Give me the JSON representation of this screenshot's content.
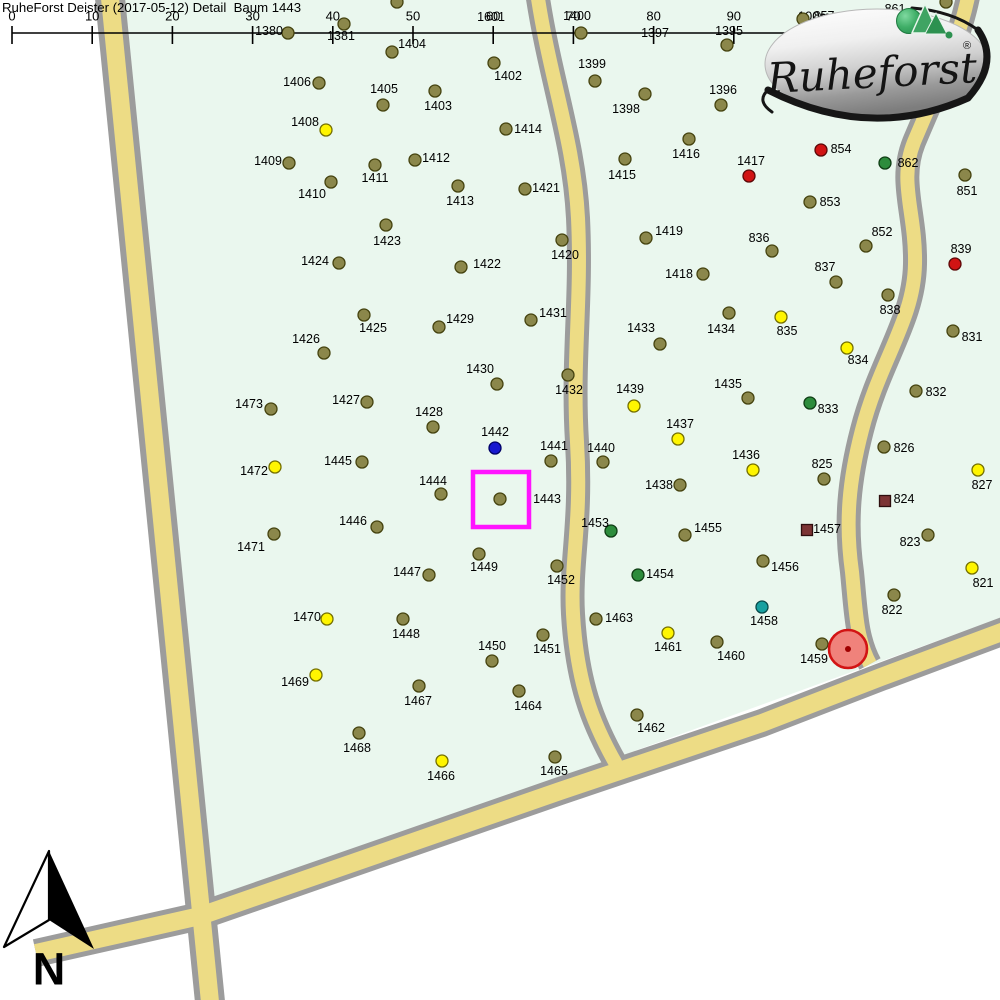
{
  "header": {
    "title": "RuheForst Deister (2017-05-12) Detail  Baum 1443"
  },
  "scale_bar": {
    "labels": [
      "0",
      "10",
      "20",
      "30",
      "40",
      "50",
      "60",
      "70",
      "80",
      "90",
      "100m"
    ],
    "x_start": 12,
    "x_step": 80.2,
    "line_y": 33,
    "tick_top": 26,
    "tick_bottom": 44,
    "label_y": 16
  },
  "logo": {
    "name": "Ruheforst",
    "registered": "®"
  },
  "north_arrow": {
    "label": "N"
  },
  "selection": {
    "selected_tree": "1443",
    "rect": {
      "x": 473,
      "y": 472,
      "w": 56,
      "h": 55,
      "color": "#FF14FF"
    },
    "marker_circle": {
      "x": 848,
      "y": 649,
      "r": 19,
      "fill": "#F0827B",
      "stroke": "#D21414",
      "core": "#A00000"
    }
  },
  "map": {
    "outside": "#FFFFFF",
    "bg": "#EAF7EE",
    "area_polygon": "124,0 1000,0 1000,618 203,908",
    "road_colors": {
      "casing": "#9C9C9C",
      "fill": "#EDDC85"
    },
    "roads": [
      {
        "name": "road-left",
        "path": "M109,-12 L211,1012",
        "outer": 30,
        "inner": 18
      },
      {
        "name": "road-bottom",
        "path": "M36,953 L200,916 L560,791 L762,723 L881,677 L1015,627",
        "outer": 28,
        "inner": 18
      },
      {
        "name": "road-middle",
        "path": "M537,-8 C550,80 574,140 578,218 C582,300 572,360 577,442 C582,524 570,562 573,614 C577,682 592,722 616,764",
        "outer": 24,
        "inner": 14
      },
      {
        "name": "road-right",
        "path": "M969,-8 C960,40 938,85 914,142 C898,182 916,212 915,264 C914,320 880,360 862,430 C849,480 845,522 852,572 C856,612 856,638 870,664",
        "outer": 24,
        "inner": 14
      }
    ]
  },
  "tree_types": {
    "o": {
      "label": "tree",
      "shape": "circle",
      "fill": "#8B874B",
      "stroke": "#45430F"
    },
    "y": {
      "label": "tree-yellow",
      "shape": "circle",
      "fill": "#FFF500",
      "stroke": "#757000"
    },
    "r": {
      "label": "tree-red",
      "shape": "circle",
      "fill": "#D11414",
      "stroke": "#5C0808"
    },
    "g": {
      "label": "tree-green",
      "shape": "circle",
      "fill": "#2D8C3C",
      "stroke": "#0F3D14"
    },
    "b": {
      "label": "tree-blue",
      "shape": "circle",
      "fill": "#1818CF",
      "stroke": "#000066"
    },
    "t": {
      "label": "tree-teal",
      "shape": "circle",
      "fill": "#17A0A0",
      "stroke": "#074A4A"
    },
    "s": {
      "label": "marker-square",
      "shape": "square",
      "fill": "#7C3434",
      "stroke": "#2E0E0E"
    }
  },
  "trees": [
    [
      "1380",
      288,
      33,
      "o",
      269,
      31
    ],
    [
      "1381",
      344,
      24,
      "o",
      341,
      36
    ],
    [
      "1404",
      392,
      52,
      "o",
      412,
      44
    ],
    [
      "1400",
      581,
      33,
      "o",
      577,
      16
    ],
    [
      "1601",
      null,
      null,
      "o",
      491,
      17
    ],
    [
      "1397",
      null,
      null,
      "o",
      655,
      33
    ],
    [
      "857",
      803,
      19,
      "o",
      824,
      16
    ],
    [
      "861",
      null,
      null,
      "o",
      895,
      9
    ],
    [
      "",
      397,
      2,
      "o",
      null,
      null
    ],
    [
      "",
      946,
      2,
      "o",
      null,
      null
    ],
    [
      "1395",
      727,
      45,
      "o",
      729,
      31
    ],
    [
      "1399",
      595,
      81,
      "o",
      592,
      64
    ],
    [
      "1402",
      494,
      63,
      "o",
      508,
      76
    ],
    [
      "1406",
      319,
      83,
      "o",
      297,
      82
    ],
    [
      "1405",
      383,
      105,
      "o",
      384,
      89
    ],
    [
      "1403",
      435,
      91,
      "o",
      438,
      106
    ],
    [
      "1398",
      645,
      94,
      "o",
      626,
      109
    ],
    [
      "1396",
      721,
      105,
      "o",
      723,
      90
    ],
    [
      "1408",
      326,
      130,
      "y",
      305,
      122
    ],
    [
      "1414",
      506,
      129,
      "o",
      528,
      129
    ],
    [
      "1416",
      689,
      139,
      "o",
      686,
      154
    ],
    [
      "854",
      821,
      150,
      "r",
      841,
      149
    ],
    [
      "862",
      885,
      163,
      "g",
      908,
      163
    ],
    [
      "1409",
      289,
      163,
      "o",
      268,
      161
    ],
    [
      "1412",
      415,
      160,
      "o",
      436,
      158
    ],
    [
      "1411",
      375,
      165,
      "o",
      375,
      178
    ],
    [
      "1415",
      625,
      159,
      "o",
      622,
      175
    ],
    [
      "851",
      965,
      175,
      "o",
      967,
      191
    ],
    [
      "1410",
      331,
      182,
      "o",
      312,
      194
    ],
    [
      "1413",
      458,
      186,
      "o",
      460,
      201
    ],
    [
      "1421",
      525,
      189,
      "o",
      546,
      188
    ],
    [
      "1417",
      749,
      176,
      "r",
      751,
      161
    ],
    [
      "853",
      810,
      202,
      "o",
      830,
      202
    ],
    [
      "1423",
      386,
      225,
      "o",
      387,
      241
    ],
    [
      "1419",
      646,
      238,
      "o",
      669,
      231
    ],
    [
      "1420",
      562,
      240,
      "o",
      565,
      255
    ],
    [
      "852",
      866,
      246,
      "o",
      882,
      232
    ],
    [
      "836",
      772,
      251,
      "o",
      759,
      238
    ],
    [
      "1424",
      339,
      263,
      "o",
      315,
      261
    ],
    [
      "1422",
      461,
      267,
      "o",
      487,
      264
    ],
    [
      "1418",
      703,
      274,
      "o",
      679,
      274
    ],
    [
      "837",
      836,
      282,
      "o",
      825,
      267
    ],
    [
      "839",
      955,
      264,
      "r",
      961,
      249
    ],
    [
      "838",
      888,
      295,
      "o",
      890,
      310
    ],
    [
      "1425",
      364,
      315,
      "o",
      373,
      328
    ],
    [
      "1429",
      439,
      327,
      "o",
      460,
      319
    ],
    [
      "1431",
      531,
      320,
      "o",
      553,
      313
    ],
    [
      "1434",
      729,
      313,
      "o",
      721,
      329
    ],
    [
      "835",
      781,
      317,
      "y",
      787,
      331
    ],
    [
      "831",
      953,
      331,
      "o",
      972,
      337
    ],
    [
      "1426",
      324,
      353,
      "o",
      306,
      339
    ],
    [
      "1433",
      660,
      344,
      "o",
      641,
      328
    ],
    [
      "834",
      847,
      348,
      "y",
      858,
      360
    ],
    [
      "1430",
      497,
      384,
      "o",
      480,
      369
    ],
    [
      "1432",
      568,
      375,
      "o",
      569,
      390
    ],
    [
      "1435",
      748,
      398,
      "o",
      728,
      384
    ],
    [
      "1439",
      634,
      406,
      "y",
      630,
      389
    ],
    [
      "833",
      810,
      403,
      "g",
      828,
      409
    ],
    [
      "832",
      916,
      391,
      "o",
      936,
      392
    ],
    [
      "1473",
      271,
      409,
      "o",
      249,
      404
    ],
    [
      "1427",
      367,
      402,
      "o",
      346,
      400
    ],
    [
      "1428",
      433,
      427,
      "o",
      429,
      412
    ],
    [
      "1442",
      495,
      448,
      "b",
      495,
      432
    ],
    [
      "1441",
      551,
      461,
      "o",
      554,
      446
    ],
    [
      "1440",
      603,
      462,
      "o",
      601,
      448
    ],
    [
      "1437",
      678,
      439,
      "y",
      680,
      424
    ],
    [
      "1436",
      753,
      470,
      "y",
      746,
      455
    ],
    [
      "826",
      884,
      447,
      "o",
      904,
      448
    ],
    [
      "1472",
      275,
      467,
      "y",
      254,
      471
    ],
    [
      "1445",
      362,
      462,
      "o",
      338,
      461
    ],
    [
      "1444",
      441,
      494,
      "o",
      433,
      481
    ],
    [
      "1443",
      500,
      499,
      "o",
      547,
      499
    ],
    [
      "825",
      824,
      479,
      "o",
      822,
      464
    ],
    [
      "827",
      978,
      470,
      "y",
      982,
      485
    ],
    [
      "1453",
      611,
      531,
      "g",
      595,
      523
    ],
    [
      "1455",
      685,
      535,
      "o",
      708,
      528
    ],
    [
      "1438",
      680,
      485,
      "o",
      659,
      485
    ],
    [
      "824",
      885,
      501,
      "s",
      904,
      499
    ],
    [
      "1457",
      807,
      530,
      "s",
      827,
      529
    ],
    [
      "823",
      928,
      535,
      "o",
      910,
      542
    ],
    [
      "1446",
      377,
      527,
      "o",
      353,
      521
    ],
    [
      "1471",
      274,
      534,
      "o",
      251,
      547
    ],
    [
      "1449",
      479,
      554,
      "o",
      484,
      567
    ],
    [
      "1452",
      557,
      566,
      "o",
      561,
      580
    ],
    [
      "1456",
      763,
      561,
      "o",
      785,
      567
    ],
    [
      "821",
      972,
      568,
      "y",
      983,
      583
    ],
    [
      "1447",
      429,
      575,
      "o",
      407,
      572
    ],
    [
      "1454",
      638,
      575,
      "g",
      660,
      574
    ],
    [
      "822",
      894,
      595,
      "o",
      892,
      610
    ],
    [
      "1458",
      762,
      607,
      "t",
      764,
      621
    ],
    [
      "1463",
      596,
      619,
      "o",
      619,
      618
    ],
    [
      "1470",
      327,
      619,
      "y",
      307,
      617
    ],
    [
      "1448",
      403,
      619,
      "o",
      406,
      634
    ],
    [
      "1461",
      668,
      633,
      "y",
      668,
      647
    ],
    [
      "1460",
      717,
      642,
      "o",
      731,
      656
    ],
    [
      "1459",
      822,
      644,
      "o",
      814,
      659
    ],
    [
      "1451",
      543,
      635,
      "o",
      547,
      649
    ],
    [
      "1450",
      492,
      661,
      "o",
      492,
      646
    ],
    [
      "1469",
      316,
      675,
      "y",
      295,
      682
    ],
    [
      "1467",
      419,
      686,
      "o",
      418,
      701
    ],
    [
      "1464",
      519,
      691,
      "o",
      528,
      706
    ],
    [
      "1462",
      637,
      715,
      "o",
      651,
      728
    ],
    [
      "1468",
      359,
      733,
      "o",
      357,
      748
    ],
    [
      "1466",
      442,
      761,
      "y",
      441,
      776
    ],
    [
      "1465",
      555,
      757,
      "o",
      554,
      771
    ]
  ]
}
